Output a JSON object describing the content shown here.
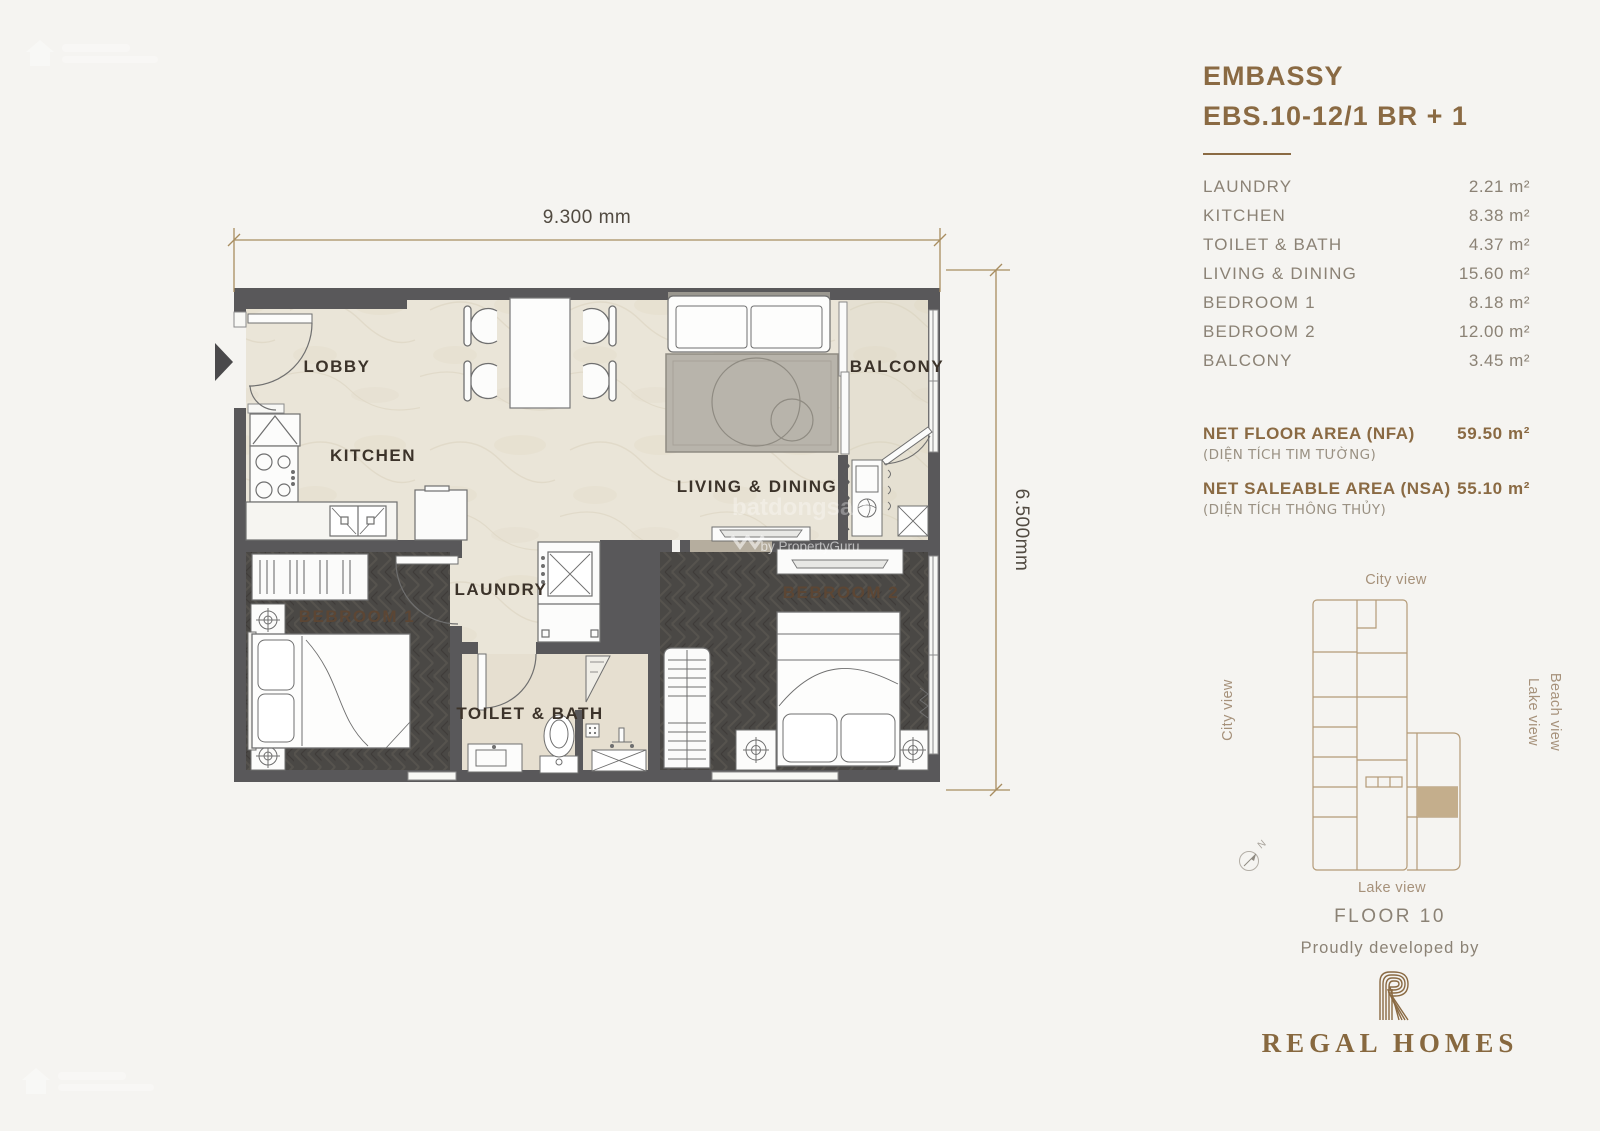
{
  "unit": {
    "project": "EMBASSY",
    "code": "EBS.10-12/1 BR + 1"
  },
  "rooms": [
    {
      "name": "LAUNDRY",
      "area": "2.21 m²"
    },
    {
      "name": "KITCHEN",
      "area": "8.38 m²"
    },
    {
      "name": "TOILET & BATH",
      "area": "4.37 m²"
    },
    {
      "name": "LIVING & DINING",
      "area": "15.60 m²"
    },
    {
      "name": "BEDROOM 1",
      "area": "8.18 m²"
    },
    {
      "name": "BEDROOM 2",
      "area": "12.00 m²"
    },
    {
      "name": "BALCONY",
      "area": "3.45 m²"
    }
  ],
  "summary": {
    "nfa_label": "NET FLOOR AREA (NFA)",
    "nfa_sub": "(DIỆN TÍCH TIM TƯỜNG)",
    "nfa_value": "59.50 m²",
    "nsa_label": "NET SALEABLE AREA (NSA)",
    "nsa_sub": "(DIỆN TÍCH THÔNG THỦY)",
    "nsa_value": "55.10 m²"
  },
  "plan": {
    "dim_top": "9.300 mm",
    "dim_right": "6.500mm",
    "labels": {
      "lobby": "LOBBY",
      "kitchen": "KITCHEN",
      "living": "LIVING & DINING",
      "balcony": "BALCONY",
      "laundry": "LAUNDRY",
      "bedroom1": "BEBROOM 1",
      "toilet": "TOILET & BATH",
      "bedroom2": "BEBROOM 2"
    }
  },
  "keyplan": {
    "top": "City view",
    "left": "City view",
    "right_outer": "Beach view",
    "right_inner": "Lake view",
    "bottom": "Lake view",
    "north": "N"
  },
  "footer": {
    "floor": "FLOOR 10",
    "tagline": "Proudly developed by",
    "developer": "REGAL HOMES"
  },
  "watermark": {
    "brand": "batdongsan",
    "byline": "by PropertyGuru"
  },
  "colors": {
    "accent": "#8a6a43",
    "panel_text": "#8b8275",
    "wall": "#59585a",
    "floor_light": "#eae5d8",
    "floor_dark": "#4a4845",
    "keyplan_line": "#b49b78",
    "keyplan_highlight": "#c4ae8c",
    "dimension_line": "#a88d60"
  }
}
